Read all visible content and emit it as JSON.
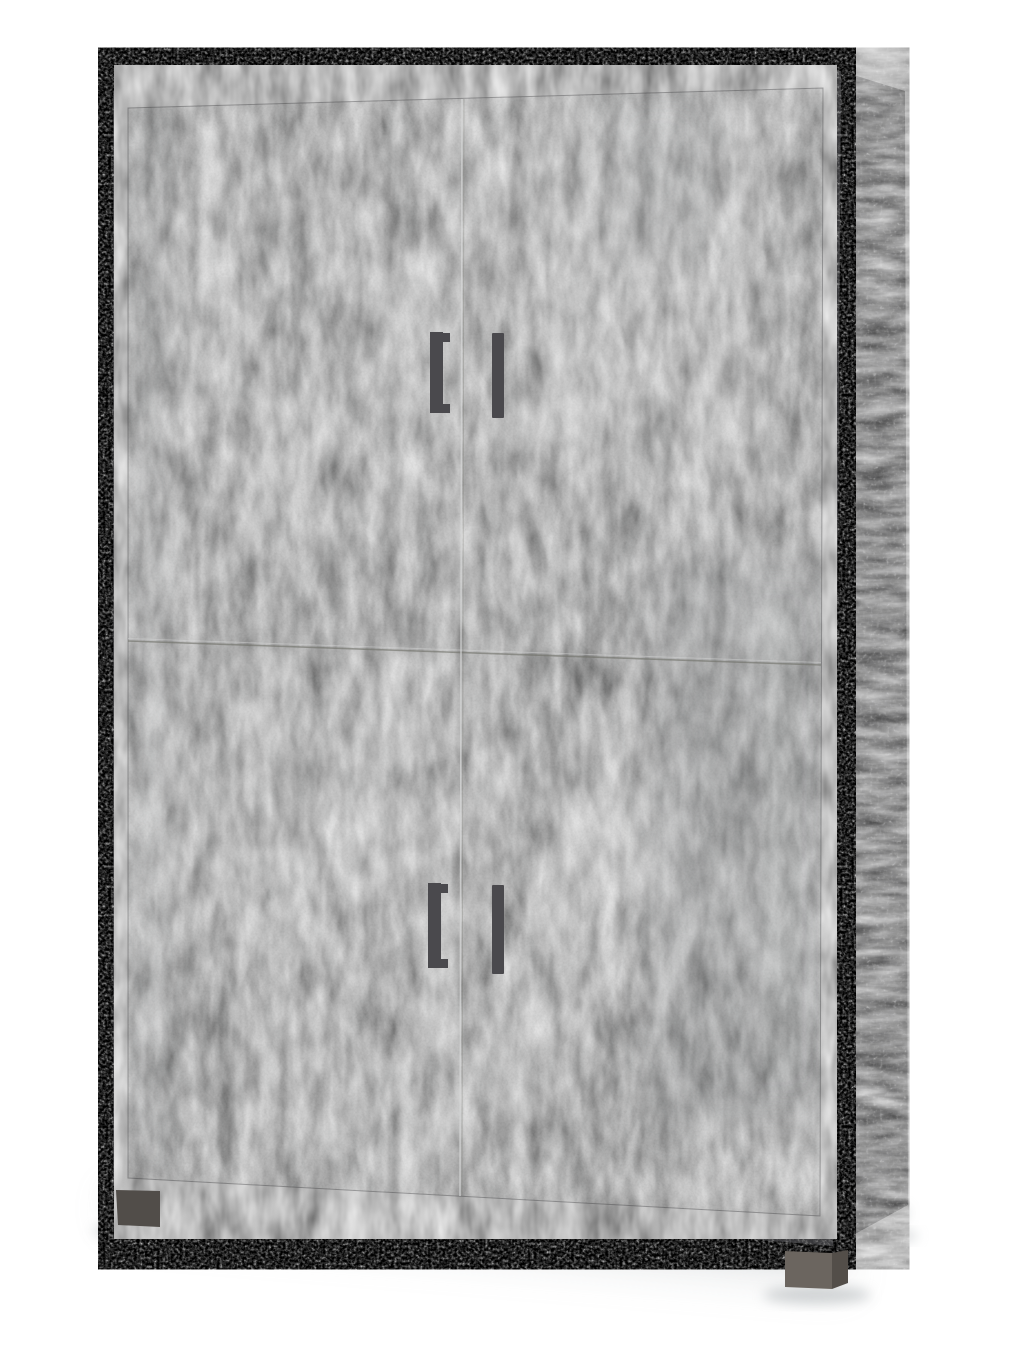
{
  "photo": {
    "subject": "Four-door tall storage cabinet with light concrete-effect doors and dark oxide concrete-effect frame, angled product view on white background",
    "background_color": "#ffffff",
    "colors": {
      "door_base": "#9c9d9d",
      "frame_base": "#39393b",
      "side_base": "#454547",
      "handle": "#4a494d",
      "foot_left": "#514d49",
      "foot_front_face": "#6b655f",
      "foot_front_side": "#534e49",
      "foot_back": "#665f58",
      "shadow": "#aeb3b6",
      "seam_light": "#d6d7d7",
      "seam_dark": "#6f7068",
      "door_gap": "#2e2e30",
      "corner_edge": "#606062"
    },
    "parts": {
      "door_count": 4,
      "handle_count": 4,
      "visible_feet_count": 3
    }
  }
}
